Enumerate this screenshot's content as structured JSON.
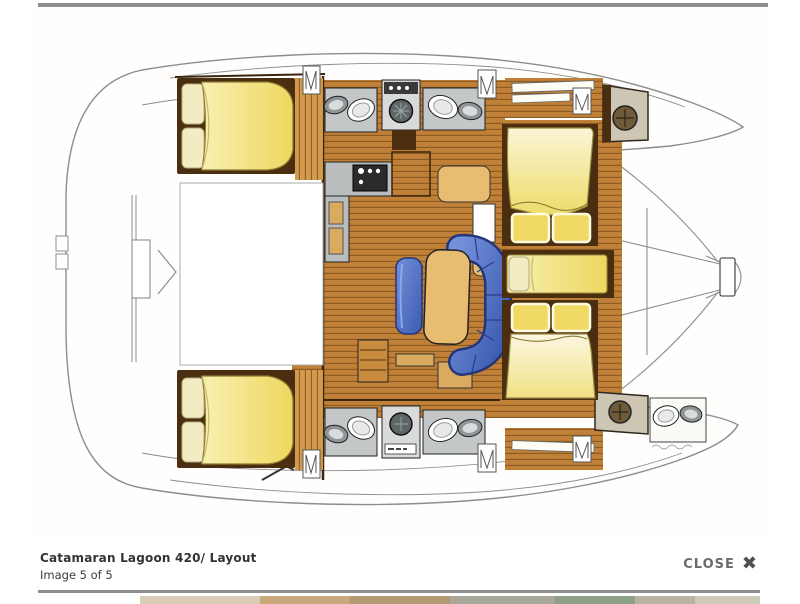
{
  "viewer": {
    "caption_title": "Catamaran Lagoon 420/ Layout",
    "caption_subtitle": "Image 5 of 5",
    "close_label": "CLOSE",
    "close_icon": "✖"
  },
  "illustration": {
    "alt": "Top-down interior layout plan of a Lagoon 420 catamaran, bows to the right",
    "areas": [
      "aft cockpit",
      "port aft cabin bed",
      "port head with toilet and sink",
      "washer compartment",
      "second port head",
      "galley with stove",
      "chart table",
      "saloon dinette with blue U-sofa and table",
      "forward double cabins",
      "centre single berth",
      "starboard aft cabin bed",
      "starboard heads",
      "forward crew head with toilet and sink",
      "deck hatches",
      "trampoline",
      "bowsprit with anchor roller"
    ],
    "palette": {
      "wood": "#c08038",
      "wood_light": "#d29a4e",
      "wood_dark": "#4a2e0f",
      "plank": "#8a5a20",
      "bed_yellow": "#f2e26d",
      "bed_cream": "#faf4cf",
      "pillow": "#f3ecc2",
      "sofa_blue": "#5377cd",
      "sofa_blue_dark": "#24357a",
      "table_tan": "#e8bd72",
      "bath_gray": "#c3c7c7",
      "fixture_gray": "#8f9597",
      "outline": "#8d8d8d",
      "ink": "#222222"
    }
  }
}
